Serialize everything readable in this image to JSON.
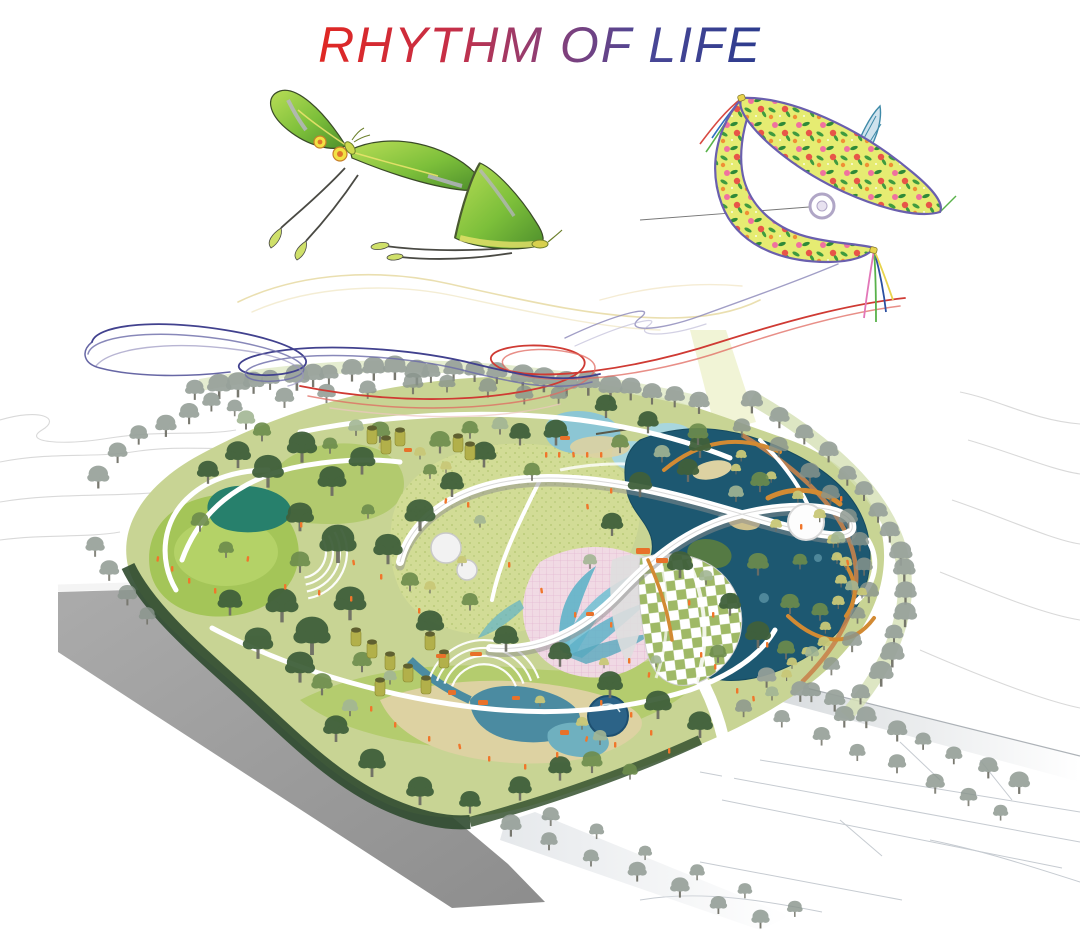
{
  "title": {
    "text": "RHYTHM OF LIFE"
  },
  "illustrations": {
    "moth_left": "green luna moth flying with long twin tails",
    "moth_center": "green luna moth gliding, side view",
    "kite": "traditional floral swallow kite with tassels and flying string",
    "ribbons": "flowing streamer lines in yellow, red and blue-purple",
    "site_plan": "isometric park masterplan with lawns, ponds, wetlands, winding elevated walkway, amphitheater steps, pink butterfly-wing plaza, diamond canopy pavilion, perimeter tree rows, gray terrain plinth and contour lines"
  },
  "colors": {
    "title_red": "#e02722",
    "title_blue": "#2c3b8d",
    "ribbon_red": "#cf3a33",
    "ribbon_blue": "#41418e",
    "ribbon_yellow": "#e6d9a2",
    "lawn": "#a4c558",
    "field": "#d2dc96",
    "base_green": "#c8d494",
    "dark_trees": "#40603b",
    "mid_trees": "#6d8c4c",
    "sage_trees": "#a3b694",
    "gray_trees": "#97a19a",
    "yellow_trees": "#c9c878",
    "pond_dark": "#1d5871",
    "pond_light": "#8cc6d4",
    "pool": "#2c6387",
    "water_play": "#4b8ba1",
    "sand": "#ddd2a2",
    "path_white": "#ffffff",
    "boardwalk_orange": "#d28a33",
    "people_orange": "#f0762b",
    "plaza_pink": "#f2d9e8",
    "wing_teal": "#5fb2c8",
    "plinth_gray": "#a0a0a0",
    "contour_gray": "#d9d9d9",
    "kite_body": "#e6ec72",
    "kite_outline": "#6a5fae",
    "canopy_green": "#9fb966",
    "moth_green": "#7cbf3a",
    "moth_yellow": "#e9e26b"
  }
}
